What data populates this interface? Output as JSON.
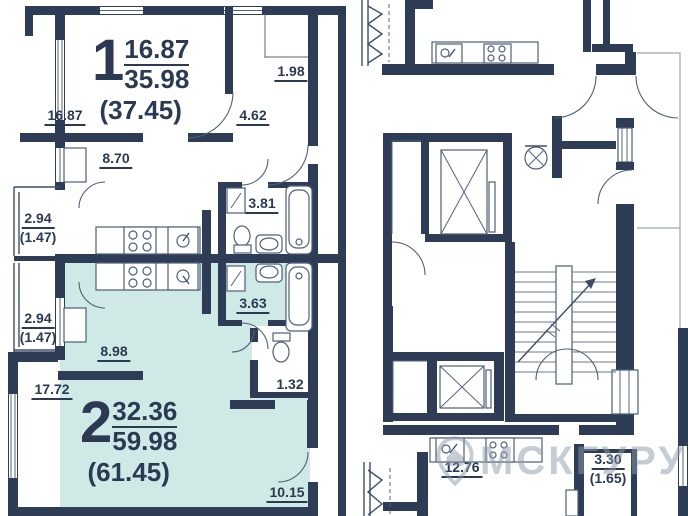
{
  "plan": {
    "apartment1": {
      "number": "1",
      "living_area": "16.87",
      "floor_area": "35.98",
      "total_area": "(37.45)",
      "rooms": {
        "living": "16.87",
        "closet": "1.98",
        "hall": "4.62",
        "kitchen": "8.70",
        "bathroom": "3.81"
      },
      "balcony": {
        "area": "2.94",
        "coef": "(1.47)"
      }
    },
    "apartment2": {
      "number": "2",
      "living_area": "32.36",
      "floor_area": "59.98",
      "total_area": "(61.45)",
      "rooms": {
        "kitchen": "8.98",
        "bathroom": "3.63",
        "wc": "1.32",
        "living": "17.72",
        "hall": "10.15"
      },
      "balcony": {
        "area": "2.94",
        "coef": "(1.47)"
      }
    },
    "neighbor": {
      "kitchen": "12.76",
      "balcony": {
        "area": "3.30",
        "coef": "(1.65)"
      }
    }
  },
  "watermark": {
    "text": "МСКГУРУ"
  },
  "colors": {
    "wall": "#2e3d55",
    "apartment2_fill": "#cfe9e6",
    "label": "#2b3a52",
    "watermark": "#8d9aa9"
  }
}
